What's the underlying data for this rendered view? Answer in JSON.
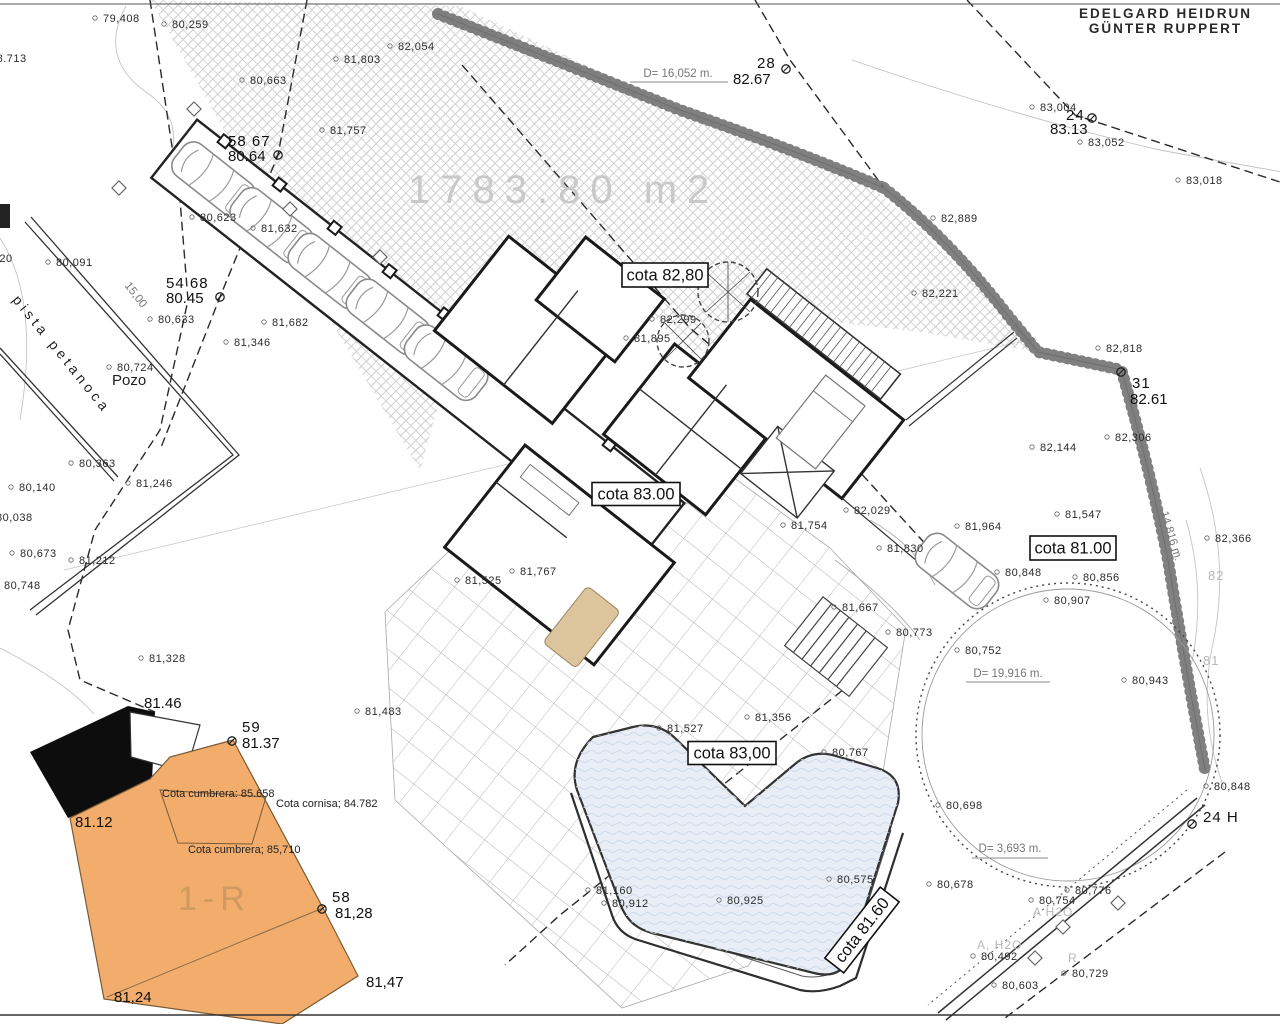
{
  "site": {
    "owner_line1": "EDELGARD  HEIDRUN",
    "owner_line2": "GÜNTER  RUPPERT",
    "parcel_area": "1783.80  m2",
    "building_unit": "1-R",
    "pista_court": "pista petanoca",
    "pozo": "Pozo"
  },
  "colors": {
    "paper": "#ffffff",
    "building_fill": "#f2ad6d",
    "roof_shadow": "#0d0d0d",
    "pool_water": "#e9eef6",
    "hatch_line": "#cdcdcd",
    "terrace_grid": "#b0b0b0",
    "faded_text": "#c9c9c9"
  },
  "annotations": {
    "cota_boxes": [
      {
        "label": "cota 82,80",
        "cx": 665,
        "cy": 275,
        "w": 86,
        "h": 24,
        "rot": 0
      },
      {
        "label": "cota 83.00",
        "cx": 636,
        "cy": 494,
        "w": 88,
        "h": 23,
        "rot": 0
      },
      {
        "label": "cota 81.00",
        "cx": 1073,
        "cy": 548,
        "w": 86,
        "h": 24,
        "rot": 0
      },
      {
        "label": "cota 83,00",
        "cx": 732,
        "cy": 753,
        "w": 88,
        "h": 23,
        "rot": 0
      },
      {
        "label": "cota 81.60",
        "cx": 862,
        "cy": 930,
        "w": 90,
        "h": 24,
        "rot": -52
      }
    ],
    "vertices": [
      {
        "num": "28",
        "elev": "82.67",
        "tx": 757,
        "ty": 68,
        "ex": 733,
        "ey": 84,
        "mx": 786,
        "my": 69
      },
      {
        "num": "24",
        "elev": "83.13",
        "tx": 1066,
        "ty": 120,
        "ex": 1050,
        "ey": 134,
        "mx": 1092,
        "my": 118
      },
      {
        "num": "58 67",
        "elev": "80.64",
        "tx": 228,
        "ty": 146,
        "ex": 228,
        "ey": 161,
        "mx": 278,
        "my": 155
      },
      {
        "num": "54 68",
        "elev": "80.45",
        "tx": 166,
        "ty": 288,
        "ex": 166,
        "ey": 303,
        "mx": 220,
        "my": 297
      },
      {
        "num": "31",
        "elev": "82.61",
        "tx": 1132,
        "ty": 388,
        "ex": 1130,
        "ey": 404,
        "mx": 1121,
        "my": 372
      },
      {
        "num": "59",
        "elev": "81.37",
        "tx": 242,
        "ty": 732,
        "ex": 242,
        "ey": 748,
        "mx": 232,
        "my": 741
      },
      {
        "num": "58",
        "elev": "81,28",
        "tx": 332,
        "ty": 902,
        "ex": 335,
        "ey": 918,
        "mx": 322,
        "my": 909
      },
      {
        "num": "24  H",
        "elev": "",
        "tx": 1203,
        "ty": 822,
        "ex": 0,
        "ey": 0,
        "mx": 1192,
        "my": 824
      }
    ],
    "corner_elevations": [
      {
        "x": 144,
        "y": 708,
        "v": "81.46"
      },
      {
        "x": 75,
        "y": 827,
        "v": "81.12"
      },
      {
        "x": 366,
        "y": 987,
        "v": "81,47"
      },
      {
        "x": 114,
        "y": 1002,
        "v": "81,24"
      }
    ],
    "spot_elevations": [
      {
        "x": 103,
        "y": 22,
        "v": "79,408"
      },
      {
        "x": 172,
        "y": 28,
        "v": "80,259"
      },
      {
        "x": -10,
        "y": 62,
        "v": "78.713"
      },
      {
        "x": 398,
        "y": 50,
        "v": "82,054"
      },
      {
        "x": 344,
        "y": 63,
        "v": "81,803"
      },
      {
        "x": 250,
        "y": 84,
        "v": "80,663"
      },
      {
        "x": 330,
        "y": 134,
        "v": "81,757"
      },
      {
        "x": 1040,
        "y": 111,
        "v": "83,004"
      },
      {
        "x": 1088,
        "y": 146,
        "v": "83,052"
      },
      {
        "x": 1186,
        "y": 184,
        "v": "83,018"
      },
      {
        "x": 941,
        "y": 222,
        "v": "82,889"
      },
      {
        "x": 922,
        "y": 297,
        "v": "82,221"
      },
      {
        "x": 1106,
        "y": 352,
        "v": "82,818"
      },
      {
        "x": 1115,
        "y": 441,
        "v": "82,306"
      },
      {
        "x": 1040,
        "y": 451,
        "v": "82,144"
      },
      {
        "x": 660,
        "y": 323,
        "v": "82,299"
      },
      {
        "x": 634,
        "y": 342,
        "v": "81,895"
      },
      {
        "x": 200,
        "y": 221,
        "v": "80,623"
      },
      {
        "x": 261,
        "y": 232,
        "v": "81,632"
      },
      {
        "x": 158,
        "y": 323,
        "v": "80,633"
      },
      {
        "x": 234,
        "y": 346,
        "v": "81,346"
      },
      {
        "x": 272,
        "y": 326,
        "v": "81,682"
      },
      {
        "x": 56,
        "y": 266,
        "v": "80,091"
      },
      {
        "x": -24,
        "y": 262,
        "v": "80.920"
      },
      {
        "x": 117,
        "y": 371,
        "v": "80,724"
      },
      {
        "x": 79,
        "y": 467,
        "v": "80,363"
      },
      {
        "x": 136,
        "y": 487,
        "v": "81,246"
      },
      {
        "x": 19,
        "y": 491,
        "v": "80,140"
      },
      {
        "x": -4,
        "y": 521,
        "v": "80,038"
      },
      {
        "x": 20,
        "y": 557,
        "v": "80,673"
      },
      {
        "x": 79,
        "y": 564,
        "v": "81,212"
      },
      {
        "x": 4,
        "y": 589,
        "v": "80,748"
      },
      {
        "x": 149,
        "y": 662,
        "v": "81,328"
      },
      {
        "x": 365,
        "y": 715,
        "v": "81,483"
      },
      {
        "x": 667,
        "y": 732,
        "v": "81,527"
      },
      {
        "x": 755,
        "y": 721,
        "v": "81,356"
      },
      {
        "x": 832,
        "y": 756,
        "v": "80,767"
      },
      {
        "x": 596,
        "y": 894,
        "v": "81,160"
      },
      {
        "x": 612,
        "y": 907,
        "v": "80,912"
      },
      {
        "x": 727,
        "y": 904,
        "v": "80,925"
      },
      {
        "x": 837,
        "y": 883,
        "v": "80,575"
      },
      {
        "x": 854,
        "y": 514,
        "v": "82,029"
      },
      {
        "x": 791,
        "y": 529,
        "v": "81,754"
      },
      {
        "x": 887,
        "y": 552,
        "v": "81,830"
      },
      {
        "x": 965,
        "y": 530,
        "v": "81,964"
      },
      {
        "x": 520,
        "y": 575,
        "v": "81,767"
      },
      {
        "x": 465,
        "y": 584,
        "v": "81,525"
      },
      {
        "x": 842,
        "y": 611,
        "v": "81,667"
      },
      {
        "x": 896,
        "y": 636,
        "v": "80,773"
      },
      {
        "x": 965,
        "y": 654,
        "v": "80,752"
      },
      {
        "x": 1132,
        "y": 684,
        "v": "80,943"
      },
      {
        "x": 1054,
        "y": 604,
        "v": "80,907"
      },
      {
        "x": 1083,
        "y": 581,
        "v": "80,856"
      },
      {
        "x": 1005,
        "y": 576,
        "v": "80,848"
      },
      {
        "x": 1065,
        "y": 518,
        "v": "81,547"
      },
      {
        "x": 1215,
        "y": 542,
        "v": "82,366"
      },
      {
        "x": 1214,
        "y": 790,
        "v": "80,848"
      },
      {
        "x": 946,
        "y": 809,
        "v": "80,698"
      },
      {
        "x": 937,
        "y": 888,
        "v": "80,678"
      },
      {
        "x": 1075,
        "y": 894,
        "v": "80,776"
      },
      {
        "x": 1039,
        "y": 904,
        "v": "80,754"
      },
      {
        "x": 981,
        "y": 960,
        "v": "80,492"
      },
      {
        "x": 1072,
        "y": 977,
        "v": "80,729"
      },
      {
        "x": 1002,
        "y": 989,
        "v": "80,603"
      }
    ],
    "dimensions": [
      {
        "label": "D=  16,052  m.",
        "x": 678,
        "y": 77,
        "rot": 0,
        "ul": [
          630,
          82,
          728,
          82
        ]
      },
      {
        "label": "D=  19,916  m.",
        "x": 1008,
        "y": 677,
        "rot": 0,
        "ul": [
          966,
          682,
          1050,
          682
        ]
      },
      {
        "label": "D=  3,693  m.",
        "x": 1010,
        "y": 852,
        "rot": 0,
        "ul": [
          972,
          858,
          1048,
          858
        ]
      },
      {
        "label": "14,816 m.",
        "x": 1168,
        "y": 537,
        "rot": 73,
        "ul": null
      },
      {
        "label": "15,00",
        "x": 133,
        "y": 297,
        "rot": 52,
        "ul": null
      }
    ],
    "roof_labels": [
      {
        "v": "Cota cumbrera: 85.658",
        "x": 162,
        "y": 797
      },
      {
        "v": "Cota cornisa; 84.782",
        "x": 276,
        "y": 807
      },
      {
        "v": "Cota cumbrera; 85,710",
        "x": 188,
        "y": 853
      }
    ],
    "grey_labels": [
      {
        "v": "82",
        "x": 1208,
        "y": 580,
        "s": 13
      },
      {
        "v": "81",
        "x": 1203,
        "y": 665,
        "s": 13
      },
      {
        "v": "A  H2O",
        "x": 1033,
        "y": 916,
        "s": 12
      },
      {
        "v": "A, H2O",
        "x": 977,
        "y": 949,
        "s": 12
      },
      {
        "v": "R",
        "x": 1068,
        "y": 962,
        "s": 12
      }
    ]
  }
}
